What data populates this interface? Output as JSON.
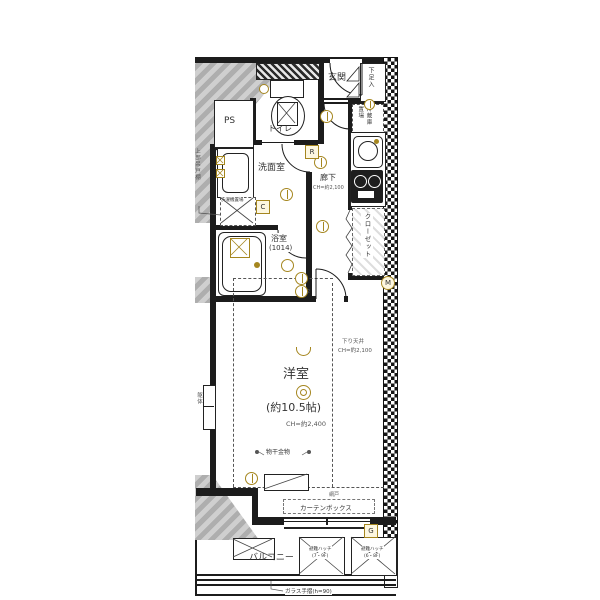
{
  "colors": {
    "accent": "#a5861f",
    "wall": "#1c1c1c",
    "slab_gray": "#b9b9b9"
  },
  "rooms": {
    "genkan": "玄関",
    "shoe_box": "下足入",
    "refrigerator": "冷蔵庫\n置場",
    "toilet": "トイレ",
    "ps": "PS",
    "washroom": "洗面室",
    "washer": "洗濯機置場",
    "hallway": "廊下",
    "hallway_ch": "CH=約2,100",
    "bathroom": "浴室",
    "bathroom_size": "(1014)",
    "closet": "クローゼット",
    "main_room": "洋室",
    "main_room_size": "(約10.5帖)",
    "main_room_ch": "CH=約2,400",
    "balcony": "バルコニー"
  },
  "annotations": {
    "lowered_ceiling": "下り天井",
    "lowered_ceiling_ch": "CH=約2,100",
    "upper_cabinet": "上部吊戸棚",
    "laundry_hardware": "物干金物",
    "screen_door": "網戸",
    "curtain_box": "カーテンボックス",
    "evac_hatch": "避難ハッチ",
    "evac_hatch1_floors": "(7・9F)",
    "evac_hatch2_floors": "(6・8F)",
    "glass_rail": "ガラス手摺(h=90)",
    "structure": "躯体"
  },
  "markers": {
    "r": "R",
    "c": "C",
    "g": "G",
    "m": "M",
    "sub2": "2"
  }
}
